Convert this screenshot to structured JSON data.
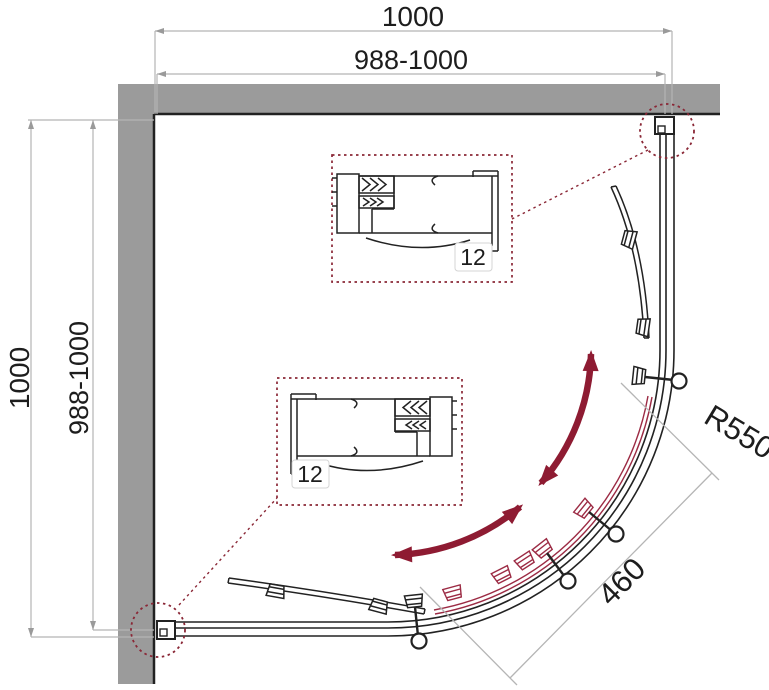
{
  "diagram": {
    "type": "shower-enclosure-plan-drawing",
    "dimensions": {
      "top_width": "1000",
      "top_adjust": "988-1000",
      "left_depth": "1000",
      "left_adjust": "988-1000",
      "radius": "R550",
      "entry_width": "460"
    },
    "details": {
      "detail_a_label": "12",
      "detail_b_label": "12"
    },
    "colors": {
      "wall_gray": "#9b9b9b",
      "line_black": "#222222",
      "dimension_gray": "#b5b5b5",
      "accent_maroon": "#8e1b32",
      "thin_red": "#9c2b44",
      "callout_maroon": "#8a2736"
    }
  }
}
